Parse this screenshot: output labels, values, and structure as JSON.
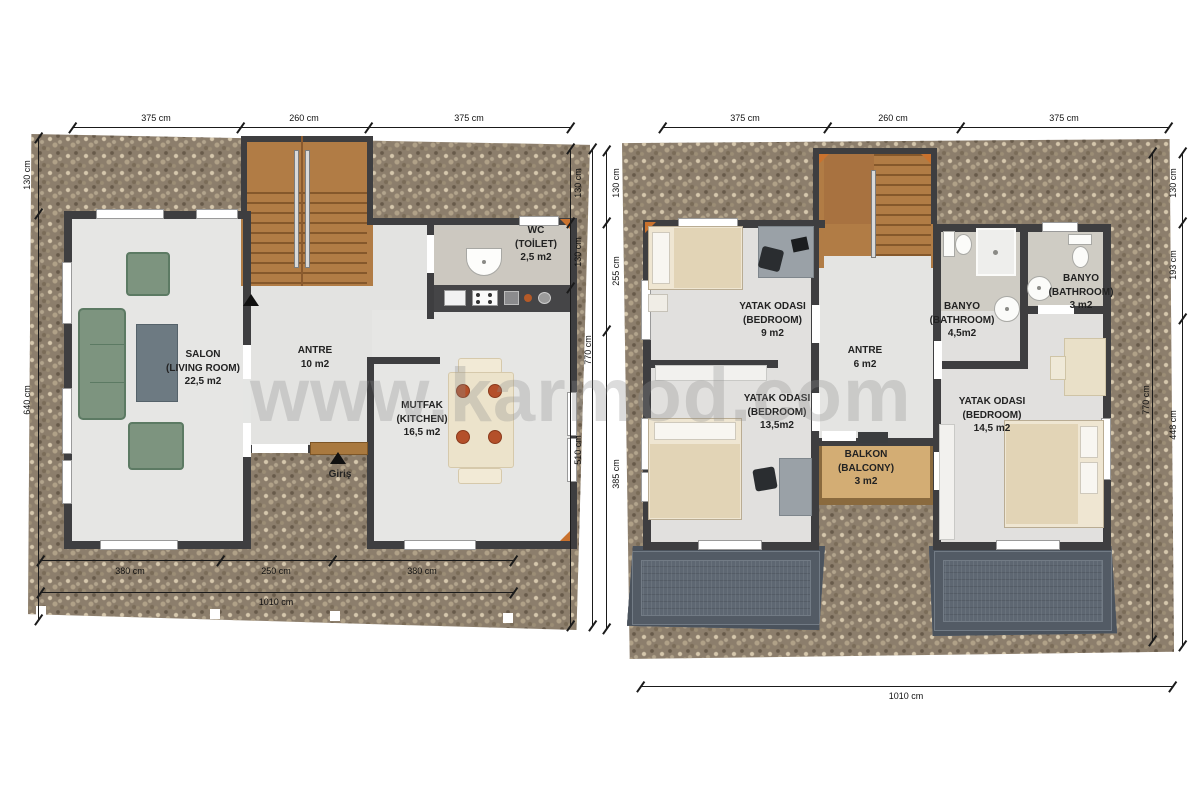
{
  "watermark": "www.karmod.com",
  "colors": {
    "wall": "#3e3e40",
    "floor_light": "#e6e6e4",
    "stone_base": "#8c7e6c",
    "stair_wood": "#b17c45",
    "balcony_wood": "#d3ad74",
    "roof_panel": "#5e6772",
    "sofa_green": "#7d947f",
    "accent_orange": "#c9722e"
  },
  "floor1": {
    "dim_top_1": "375 cm",
    "dim_top_2": "260 cm",
    "dim_top_3": "375 cm",
    "dim_left_1": "130 cm",
    "dim_left_2": "640 cm",
    "dim_right_1": "130 cm",
    "dim_right_2": "130 cm",
    "dim_right_3": "510 cm",
    "dim_right_total": "770 cm",
    "dim_bottom_1": "380 cm",
    "dim_bottom_2": "250 cm",
    "dim_bottom_3": "380 cm",
    "dim_bottom_total": "1010 cm",
    "entrance": "Giriş",
    "rooms": {
      "salon": {
        "tr": "SALON",
        "en": "(LIVING ROOM)",
        "area": "22,5 m2"
      },
      "antre": {
        "tr": "ANTRE",
        "area": "10  m2"
      },
      "mutfak": {
        "tr": "MUTFAK",
        "en": "(KITCHEN)",
        "area": "16,5  m2"
      },
      "wc": {
        "tr": "WC",
        "en": "(TOİLET)",
        "area": "2,5  m2"
      }
    }
  },
  "floor2": {
    "dim_top_1": "375 cm",
    "dim_top_2": "260 cm",
    "dim_top_3": "375 cm",
    "dim_left_1": "130 cm",
    "dim_left_2": "255 cm",
    "dim_left_3": "385 cm",
    "dim_right_1": "130 cm",
    "dim_right_2": "193 cm",
    "dim_right_3": "448 cm",
    "dim_right_total": "770 cm",
    "dim_bottom_total": "1010 cm",
    "rooms": {
      "bedroom1": {
        "tr": "YATAK ODASI",
        "en": "(BEDROOM)",
        "area": "9 m2"
      },
      "banyo1": {
        "tr": "BANYO",
        "en": "(BATHROOM)",
        "area": "4,5m2"
      },
      "banyo2": {
        "tr": "BANYO",
        "en": "(BATHROOM)",
        "area": "3 m2"
      },
      "antre": {
        "tr": "ANTRE",
        "area": "6  m2"
      },
      "bedroom2": {
        "tr": "YATAK ODASI",
        "en": "(BEDROOM)",
        "area": "13,5m2"
      },
      "balkon": {
        "tr": "BALKON",
        "en": "(BALCONY)",
        "area": "3 m2"
      },
      "bedroom3": {
        "tr": "YATAK ODASI",
        "en": "(BEDROOM)",
        "area": "14,5 m2"
      }
    }
  }
}
